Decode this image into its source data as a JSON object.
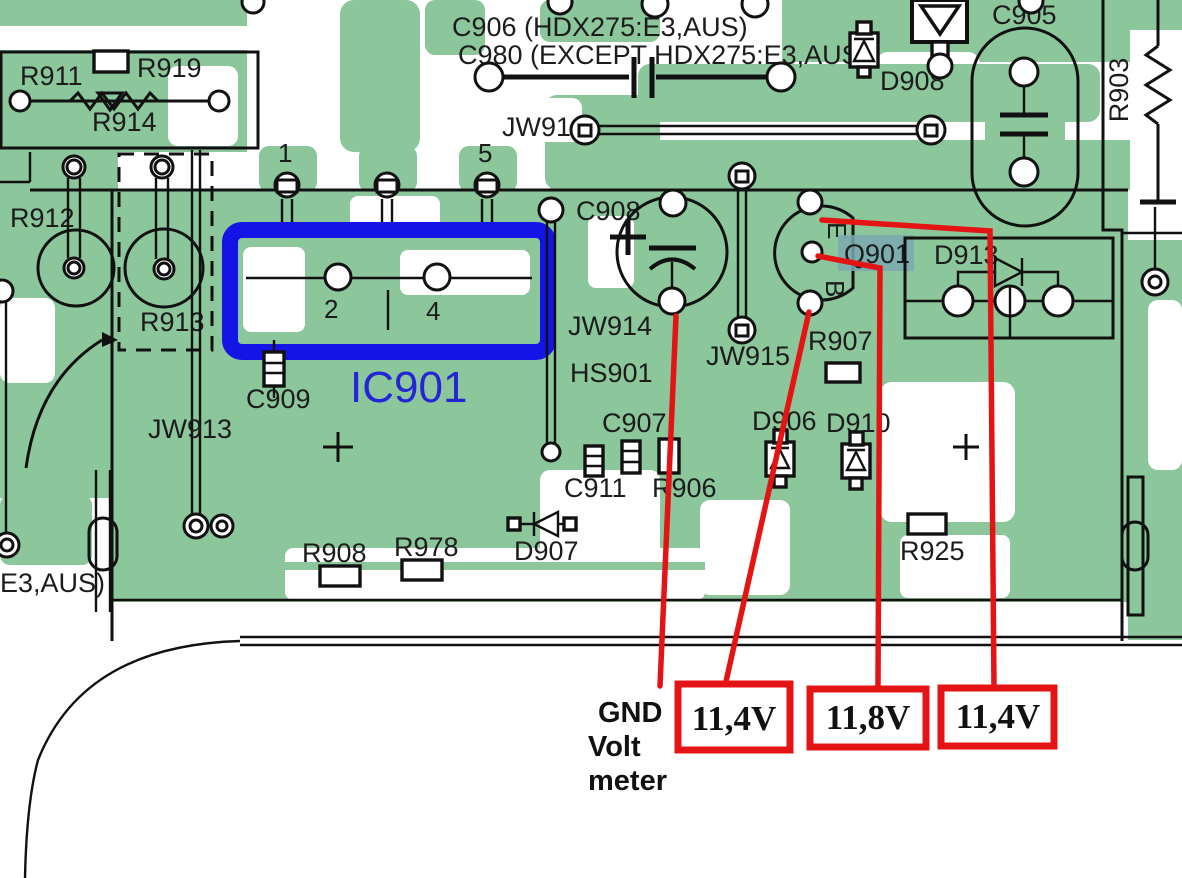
{
  "diagram": {
    "kind": "pcb-component-layout",
    "colors": {
      "pcb_green": "#8cc69b",
      "ic_outline_blue": "#1414e6",
      "ic_text_blue": "#2525d8",
      "annotation_red": "#e41414",
      "q901_highlight": "#7aa8b0",
      "silkscreen_black": "#1c1c1c"
    },
    "labels": {
      "r911": "R911",
      "r919": "R919",
      "r914": "R914",
      "r912": "R912",
      "r913": "R913",
      "jw913": "JW913",
      "c909": "C909",
      "ic901": "IC901",
      "jw916": "JW916",
      "c908": "C908",
      "jw914": "JW914",
      "hs901": "HS901",
      "jw915": "JW915",
      "c907": "C907",
      "c911": "C911",
      "r906": "R906",
      "d907": "D907",
      "r908": "R908",
      "r978": "R978",
      "d906": "D906",
      "d910": "D910",
      "r907": "R907",
      "q901": "Q901",
      "d913": "D913",
      "d908": "D908",
      "c905": "C905",
      "r903": "R903",
      "r925": "R925",
      "partial_left_note": "E3,AUS)"
    },
    "notes": {
      "c906_variant": "C906 (HDX275:E3,AUS)",
      "c980_variant": "C980 (EXCEPT HDX275:E3,AUS)"
    },
    "pins": {
      "p1": "1",
      "p2": "2",
      "p4": "4",
      "p5": "5"
    },
    "transistor_pins": {
      "e": "E",
      "b": "B"
    },
    "annotations": {
      "gnd": [
        "GND",
        "Volt",
        "meter"
      ],
      "voltages": [
        "11,4V",
        "11,8V",
        "11,4V"
      ]
    }
  }
}
